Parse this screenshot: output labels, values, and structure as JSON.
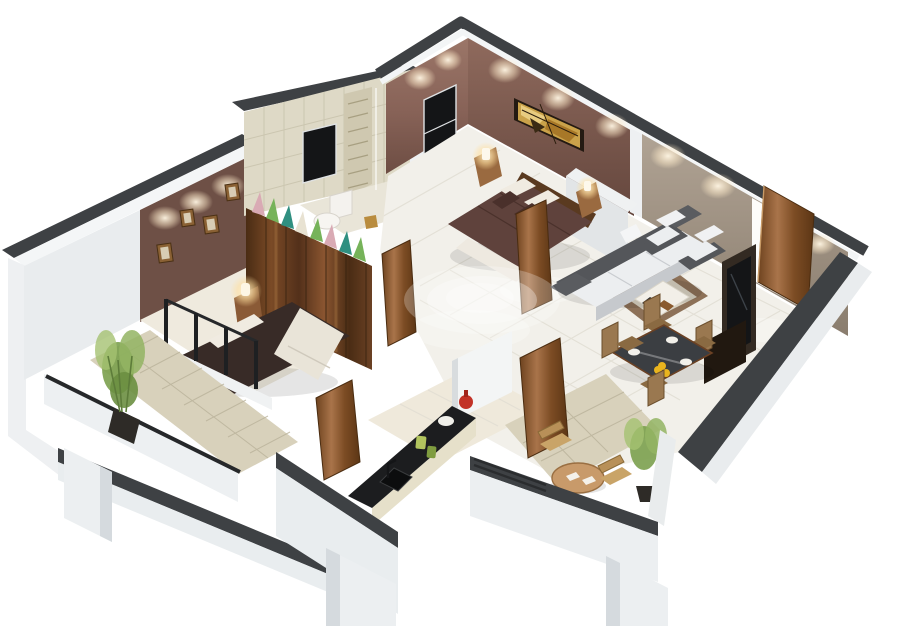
{
  "scene": {
    "title": "3D isometric cutaway floor plan render of a 2-bedroom apartment",
    "style": "photorealistic 3D floor plan on plain white background, no text or labels visible",
    "canvas": {
      "width": 900,
      "height": 626,
      "background": "#ffffff"
    },
    "rooms": [
      {
        "id": "master-bedroom",
        "label": "master bedroom",
        "position": "top-center",
        "furniture": [
          "double bed with maroon duvet",
          "wooden headboard",
          "pillows",
          "two nightstands with glowing lamps",
          "stained-glass wall art",
          "black framed window",
          "ceiling spotlights"
        ]
      },
      {
        "id": "living-room",
        "label": "living room",
        "position": "center-right",
        "furniture": [
          "three-seat sofa with white cushions",
          "two armchairs",
          "coffee table",
          "brown bordered area rug",
          "tv unit with black screen",
          "open wooden entrance door",
          "textured taupe feature wall"
        ]
      },
      {
        "id": "dining-area",
        "label": "dining area",
        "position": "bottom-right",
        "furniture": [
          "dark glass dining table",
          "four wooden high-back chairs",
          "white plates",
          "yellow fruit bowl"
        ]
      },
      {
        "id": "kitchen",
        "label": "kitchen",
        "position": "bottom-center",
        "furniture": [
          "black countertop",
          "sink with faucet",
          "red vase",
          "green canisters",
          "white bowl",
          "tall white cabinet"
        ]
      },
      {
        "id": "bathroom",
        "label": "bathroom",
        "position": "top-center-left",
        "furniture": [
          "beige tiled wall",
          "decorative tile strip",
          "black wall screen",
          "toilet",
          "washbasin",
          "shower glass",
          "open wooden door"
        ]
      },
      {
        "id": "bedroom-2",
        "label": "bedroom 2",
        "position": "center-left",
        "furniture": [
          "double bed with dark duvet and white runner",
          "wooden wardrobe",
          "row of triangle cushions on wardrobe",
          "four picture frames on brown accent wall",
          "glowing bedside lamp",
          "glass window wall with black posts",
          "open wooden door"
        ]
      },
      {
        "id": "left-balcony",
        "label": "left balcony",
        "position": "bottom-left",
        "furniture": [
          "potted bamboo plant",
          "black railing on white parapet",
          "beige tiled walkway"
        ]
      },
      {
        "id": "sitout-balcony",
        "label": "sit-out balcony",
        "position": "bottom-right",
        "furniture": [
          "round wooden table",
          "two wicker chairs",
          "potted plant",
          "open wooden door",
          "glass railing"
        ]
      }
    ],
    "palette": {
      "bg_white": "#ffffff",
      "cap_dark": "#3e4144",
      "wall_white": "#eef0f2",
      "wall_white_shade": "#e9edef",
      "wall_mauve": "#876257",
      "wall_taupe": "#a29585",
      "wall_beige_tile": "#ded9c6",
      "accent_wall_brown": "#6e5046",
      "wood": "#8a5a36",
      "wood_dark": "#5a3a20",
      "duvet_master": "#5f423c",
      "duvet_bedroom2": "#382b27",
      "pillow_cream": "#f0ebe1",
      "floor_tile": "#f2f0ea",
      "balcony_tile": "#d8d1bb",
      "kitchen_floor": "#efe9db",
      "sofa_frame": "#54565a",
      "cushion_white": "#eceef0",
      "rug_border": "#8d7158",
      "rug_center": "#d9d2c2",
      "counter_black": "#1c1d1f",
      "glass_table": "#3b3e42",
      "accent_red": "#c23227",
      "accent_yellow": "#e9b41e",
      "plant_green": "#7ba04e",
      "cushion_teal": "#2f8f80",
      "cushion_green": "#76b35a",
      "cushion_pink": "#d9aab4",
      "cushion_cream": "#e8e2d2",
      "tv_black": "#141517",
      "lamp_glow": "#ffe9c4"
    }
  }
}
